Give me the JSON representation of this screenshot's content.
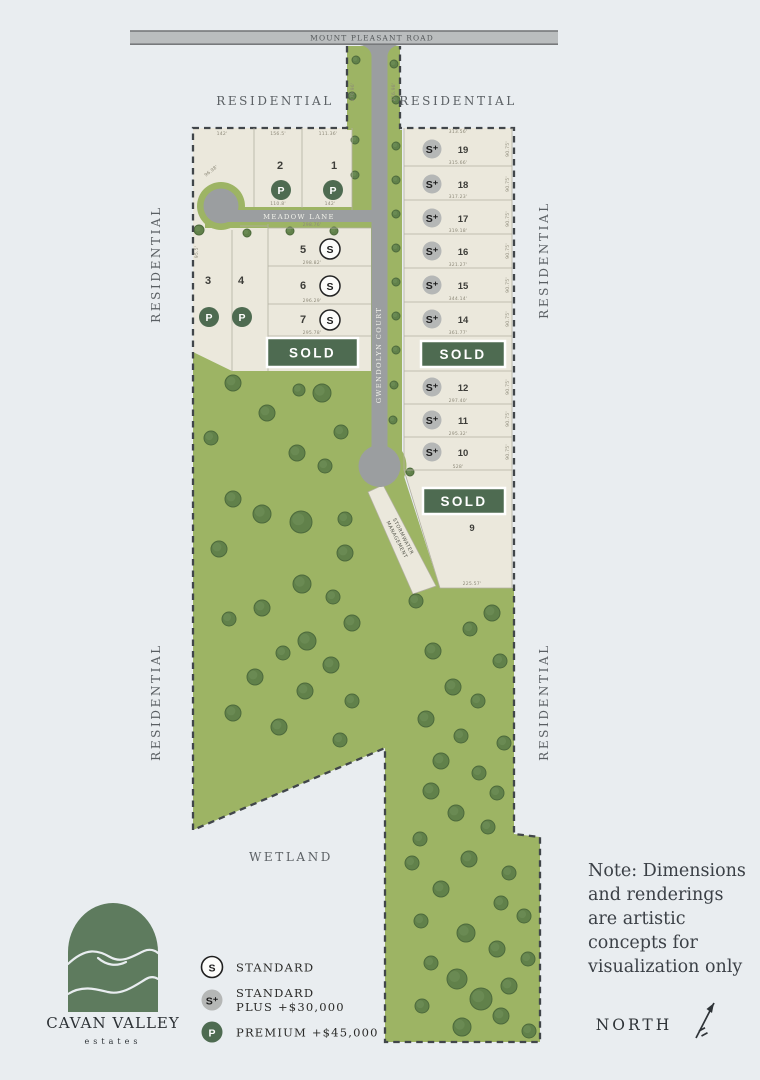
{
  "map": {
    "roads": {
      "mount_pleasant": "MOUNT PLEASANT ROAD",
      "meadow_lane": "MEADOW LANE",
      "gwendolyn_court": "GWENDOLYN COURT"
    },
    "surroundings": {
      "residential": "RESIDENTIAL",
      "wetland": "WETLAND",
      "stormwater_line1": "STORMWATER",
      "stormwater_line2": "MANAGEMENT"
    },
    "sold_label": "SOLD",
    "lots": {
      "l1": {
        "num": "1",
        "sym": "P"
      },
      "l2": {
        "num": "2",
        "sym": "P"
      },
      "l3": {
        "num": "3",
        "sym": "P"
      },
      "l4": {
        "num": "4",
        "sym": "P"
      },
      "l5": {
        "num": "5",
        "sym": "S"
      },
      "l6": {
        "num": "6",
        "sym": "S"
      },
      "l7": {
        "num": "7",
        "sym": "S"
      },
      "l9": {
        "num": "9",
        "sym": ""
      },
      "l10": {
        "num": "10",
        "sym": "S⁺"
      },
      "l11": {
        "num": "11",
        "sym": "S⁺"
      },
      "l12": {
        "num": "12",
        "sym": "S⁺"
      },
      "l14": {
        "num": "14",
        "sym": "S⁺"
      },
      "l15": {
        "num": "15",
        "sym": "S⁺"
      },
      "l16": {
        "num": "16",
        "sym": "S⁺"
      },
      "l17": {
        "num": "17",
        "sym": "S⁺"
      },
      "l18": {
        "num": "18",
        "sym": "S⁺"
      },
      "l19": {
        "num": "19",
        "sym": "S⁺"
      }
    },
    "dims": {
      "top": [
        "142'",
        "156.5'",
        "111.36'"
      ],
      "lot2_bottom": "110.8'",
      "lot1_bottom": "142'",
      "wedge": "96.98'",
      "left_edge": "95.5'",
      "rows_left": [
        "298.76'",
        "298.82'",
        "296.29'",
        "295.78'"
      ],
      "right_top": "313.56'",
      "rows_right": [
        "315.66'",
        "317.23'",
        "319.18'",
        "321.27'",
        "344.14'",
        "361.77'",
        "297.40'",
        "295.32'",
        "528'"
      ],
      "side_right": "90.75'",
      "lot9_bottom": "225.57'",
      "neck_left": "270.96'",
      "neck_right": "276.98'"
    }
  },
  "legend": {
    "items": [
      {
        "symbol": "S",
        "line1": "STANDARD",
        "line2": ""
      },
      {
        "symbol": "S⁺",
        "line1": "STANDARD",
        "line2": "PLUS +$30,000"
      },
      {
        "symbol": "P",
        "line1": "PREMIUM +$45,000",
        "line2": ""
      }
    ]
  },
  "note_lines": [
    "Note: Dimensions",
    "and renderings",
    "are artistic",
    "concepts for",
    "visualization only"
  ],
  "north_label": "NORTH",
  "logo": {
    "title": "CAVAN VALLEY",
    "subtitle": "estates"
  },
  "colors": {
    "background": "#e9edf0",
    "lot_fill": "#ebe8dc",
    "green": "#9db464",
    "tree": "#61814a",
    "road": "#9b9ea0",
    "sold_badge": "#4e6b51",
    "premium_marker": "#4e6b51",
    "standard_plus_marker": "#b5b7b6",
    "boundary": "#41464a"
  }
}
